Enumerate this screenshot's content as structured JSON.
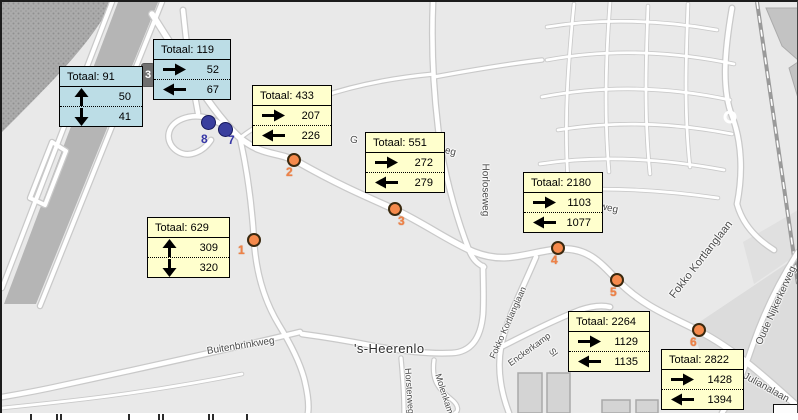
{
  "map_meta": {
    "place_name": "'s-Heerenlo",
    "road_badge": {
      "label": "3"
    }
  },
  "colors": {
    "callout_yellow": "#ffffcd",
    "callout_blue": "#bcdde6",
    "point_orange": "#f58a4c",
    "point_blue": "#3a3f9e",
    "label_orange": "#ee8147",
    "label_blue": "#3636a6",
    "map_background": "#e9e9e9",
    "road_fill": "#ffffff",
    "road_casing": "#c9c9c9"
  },
  "street_labels": [
    {
      "id": "buitenbrinkweg",
      "text": "Buitenbrinkweg",
      "x": 205,
      "y": 350,
      "rotate": -9,
      "size": 10,
      "place": false
    },
    {
      "id": "s-heerenlo",
      "text": "'s-Heerenlo",
      "x": 352,
      "y": 346,
      "rotate": 0,
      "size": 13,
      "place": true
    },
    {
      "id": "horloseweg",
      "text": "Horloseweg",
      "x": 483,
      "y": 162,
      "rotate": 90,
      "size": 10,
      "place": false
    },
    {
      "id": "fokko-kortlanglaan-groot",
      "text": "Fokko Kortlanglaan",
      "x": 670,
      "y": 295,
      "rotate": -52,
      "size": 11,
      "place": false
    },
    {
      "id": "fokko-kortlanglaan-klein",
      "text": "Fokko Kortlanglaan",
      "x": 490,
      "y": 356,
      "rotate": -66,
      "size": 9,
      "place": false
    },
    {
      "id": "enckerkamp",
      "text": "Enckerkamp",
      "x": 507,
      "y": 362,
      "rotate": -36,
      "size": 9,
      "place": false
    },
    {
      "id": "oude-nijkerkerweg",
      "text": "Oude Nijkerkerweg",
      "x": 757,
      "y": 343,
      "rotate": -66,
      "size": 10,
      "place": false
    },
    {
      "id": "julianalaan",
      "text": "Julianalaan",
      "x": 742,
      "y": 374,
      "rotate": 29,
      "size": 10,
      "place": false
    },
    {
      "id": "horsterweg",
      "text": "Horsterweg",
      "x": 406,
      "y": 366,
      "rotate": 86,
      "size": 9,
      "place": false
    },
    {
      "id": "molenkamp",
      "text": "Molenkamp",
      "x": 436,
      "y": 372,
      "rotate": 72,
      "size": 9,
      "place": false
    },
    {
      "id": "fragment-g",
      "text": "G",
      "x": 348,
      "y": 138,
      "rotate": 12,
      "size": 10,
      "place": false
    },
    {
      "id": "fragment-eg",
      "text": "eg",
      "x": 443,
      "y": 149,
      "rotate": 14,
      "size": 10,
      "place": false
    },
    {
      "id": "fragment-weg",
      "text": "weg",
      "x": 598,
      "y": 205,
      "rotate": 12,
      "size": 10,
      "place": false
    },
    {
      "id": "fragment-sl",
      "text": "Sl",
      "x": 549,
      "y": 347,
      "rotate": 55,
      "size": 9,
      "place": false
    }
  ],
  "points": [
    {
      "id": "punt-1",
      "label": "1",
      "x": 252,
      "y": 238,
      "type": "orange",
      "lx": 236,
      "ly": 241
    },
    {
      "id": "punt-2",
      "label": "2",
      "x": 292,
      "y": 158,
      "type": "orange",
      "lx": 284,
      "ly": 163
    },
    {
      "id": "punt-3",
      "label": "3",
      "x": 393,
      "y": 207,
      "type": "orange",
      "lx": 396,
      "ly": 212
    },
    {
      "id": "punt-4",
      "label": "4",
      "x": 556,
      "y": 246,
      "type": "orange",
      "lx": 549,
      "ly": 251
    },
    {
      "id": "punt-5",
      "label": "5",
      "x": 615,
      "y": 278,
      "type": "orange",
      "lx": 608,
      "ly": 283
    },
    {
      "id": "punt-6",
      "label": "6",
      "x": 697,
      "y": 328,
      "type": "orange",
      "lx": 688,
      "ly": 333
    },
    {
      "id": "punt-7",
      "label": "7",
      "x": 223,
      "y": 127,
      "type": "blue",
      "lx": 226,
      "ly": 131
    },
    {
      "id": "punt-8",
      "label": "8",
      "x": 206,
      "y": 120,
      "type": "blue",
      "lx": 199,
      "ly": 130
    }
  ],
  "callouts": [
    {
      "id": "totaal-91",
      "style": "blue",
      "x": 57,
      "y": 64,
      "w": 84,
      "title": "Totaal: 91",
      "rows": [
        {
          "dir": "up",
          "value": "50"
        },
        {
          "dir": "down",
          "value": "41"
        }
      ]
    },
    {
      "id": "totaal-119",
      "style": "blue",
      "x": 151,
      "y": 37,
      "w": 78,
      "title": "Totaal: 119",
      "rows": [
        {
          "dir": "right",
          "value": "52"
        },
        {
          "dir": "left",
          "value": "67"
        }
      ]
    },
    {
      "id": "totaal-433",
      "style": "yellow",
      "x": 250,
      "y": 83,
      "w": 80,
      "title": "Totaal: 433",
      "rows": [
        {
          "dir": "right",
          "value": "207"
        },
        {
          "dir": "left",
          "value": "226"
        }
      ]
    },
    {
      "id": "totaal-551",
      "style": "yellow",
      "x": 363,
      "y": 130,
      "w": 80,
      "title": "Totaal: 551",
      "rows": [
        {
          "dir": "right",
          "value": "272"
        },
        {
          "dir": "left",
          "value": "279"
        }
      ]
    },
    {
      "id": "totaal-2180",
      "style": "yellow",
      "x": 521,
      "y": 170,
      "w": 80,
      "title": "Totaal: 2180",
      "rows": [
        {
          "dir": "right",
          "value": "1103"
        },
        {
          "dir": "left",
          "value": "1077"
        }
      ]
    },
    {
      "id": "totaal-629",
      "style": "yellow",
      "x": 145,
      "y": 215,
      "w": 83,
      "title": "Totaal: 629",
      "rows": [
        {
          "dir": "up",
          "value": "309"
        },
        {
          "dir": "down",
          "value": "320"
        }
      ]
    },
    {
      "id": "totaal-2264",
      "style": "yellow",
      "x": 566,
      "y": 309,
      "w": 82,
      "title": "Totaal: 2264",
      "rows": [
        {
          "dir": "right",
          "value": "1129"
        },
        {
          "dir": "left",
          "value": "1135"
        }
      ]
    },
    {
      "id": "totaal-2822",
      "style": "yellow",
      "x": 659,
      "y": 347,
      "w": 83,
      "title": "Totaal: 2822",
      "rows": [
        {
          "dir": "right",
          "value": "1428"
        },
        {
          "dir": "left",
          "value": "1394"
        }
      ]
    }
  ]
}
